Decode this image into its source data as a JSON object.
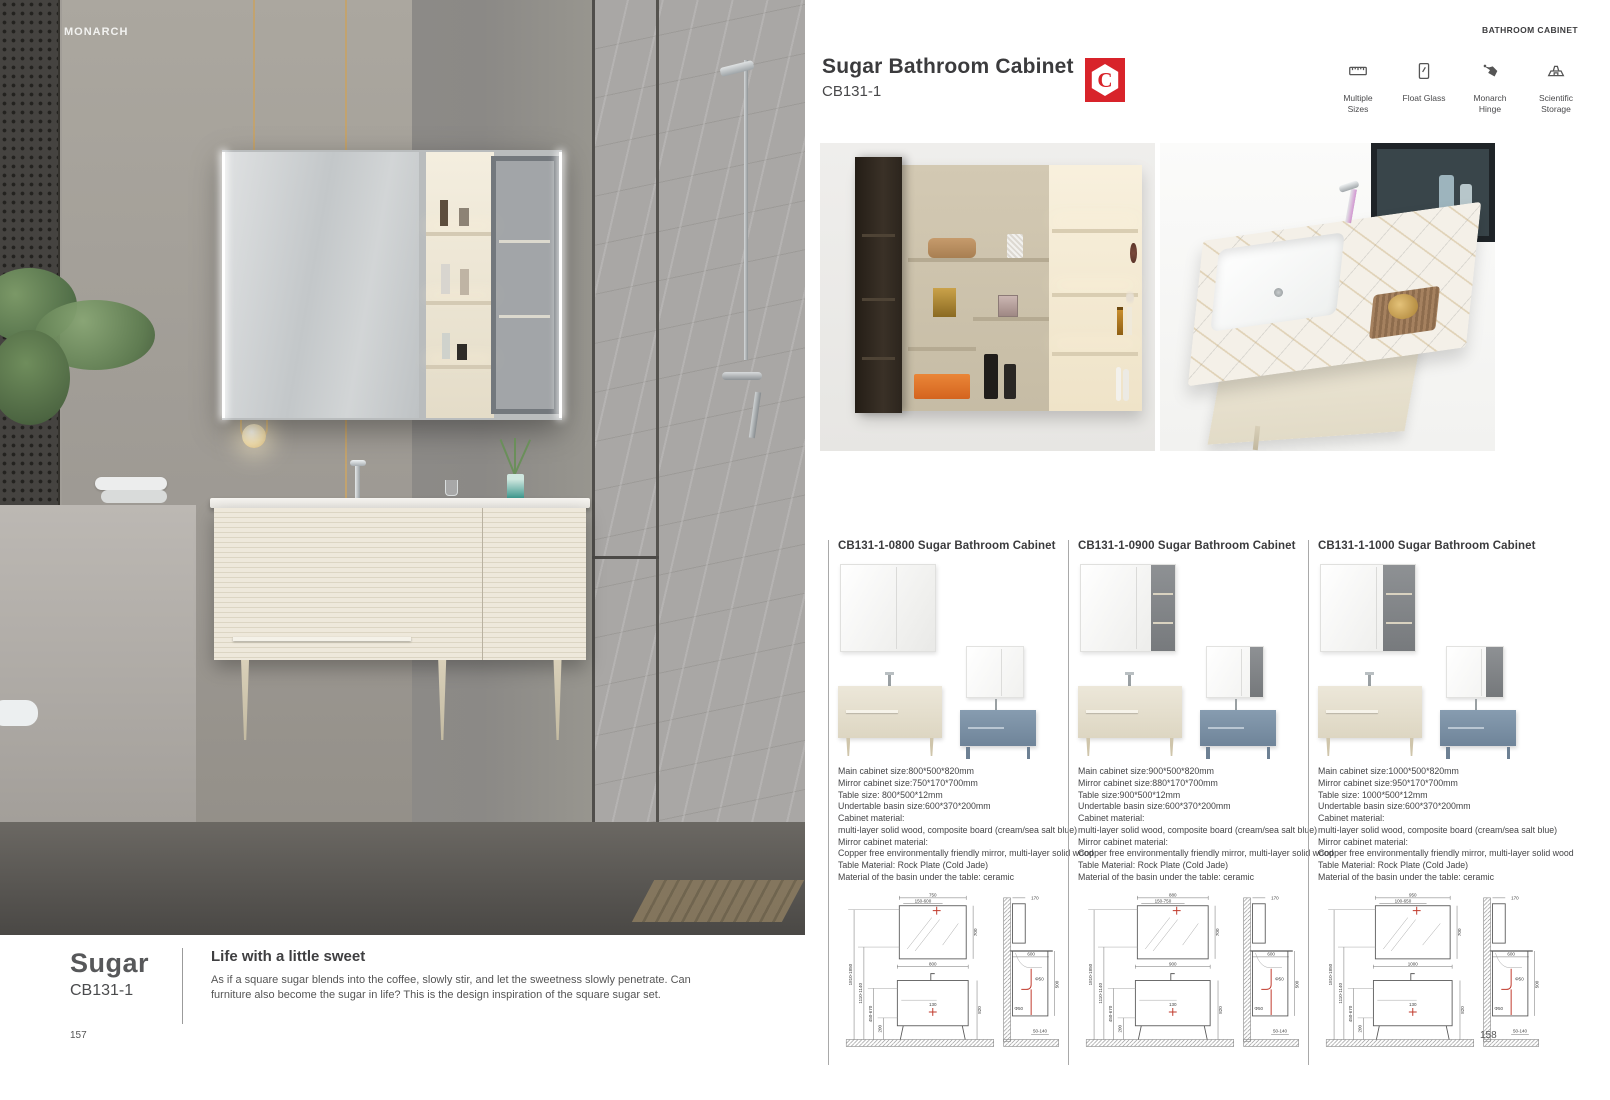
{
  "palette": {
    "accent_red": "#d8232a",
    "text_dark": "#3b3b3d",
    "cream": "#e8e3d6",
    "sea_salt_blue": "#7e93a6"
  },
  "left_page": {
    "brand": "MONARCH",
    "series_name": "Sugar",
    "series_code": "CB131-1",
    "slogan_title": "Life with a little sweet",
    "slogan_body": "As if a square sugar blends into the coffee, slowly stir, and let the sweetness slowly penetrate. Can furniture also become the sugar in life? This is the design inspiration of the square sugar set.",
    "page_number": "157"
  },
  "right_page": {
    "header_label": "BATHROOM CABINET",
    "title": "Sugar Bathroom Cabinet",
    "code": "CB131-1",
    "logo_letter": "C",
    "features": [
      {
        "icon": "multiple-sizes-icon",
        "label": "Multiple Sizes"
      },
      {
        "icon": "float-glass-icon",
        "label": "Float Glass"
      },
      {
        "icon": "monarch-hinge-icon",
        "label": "Monarch Hinge"
      },
      {
        "icon": "scientific-storage-icon",
        "label": "Scientific Storage"
      }
    ],
    "page_number": "158",
    "variants": [
      {
        "title": "CB131-1-0800 Sugar Bathroom Cabinet",
        "specs": [
          "Main cabinet size:800*500*820mm",
          "Mirror cabinet size:750*170*700mm",
          "Table size: 800*500*12mm",
          "Undertable basin size:600*370*200mm",
          "Cabinet material:",
          "multi-layer solid wood, composite board (cream/sea salt blue)",
          "Mirror cabinet material:",
          "Copper free environmentally friendly mirror, multi-layer solid wood",
          "Table Material: Rock Plate (Cold Jade)",
          "Material of the basin under the table: ceramic"
        ],
        "drawing": {
          "front": {
            "mirror_width": "750",
            "install_range": "150-600",
            "mirror_height": "700",
            "cabinet_width": "800",
            "cabinet_height": "820",
            "drain_offset": "130",
            "height_range_1": "1810-1850",
            "height_range_2": "1110-1140",
            "height_range_3": "450-670",
            "skirt_height": "200"
          },
          "side": {
            "depth": "170",
            "basin_width": "600",
            "height": "500",
            "drain_diameter": "Φ50",
            "floor_gap": "50-140"
          }
        }
      },
      {
        "title": "CB131-1-0900 Sugar Bathroom Cabinet",
        "specs": [
          "Main cabinet size:900*500*820mm",
          "Mirror cabinet size:880*170*700mm",
          "Table size:900*500*12mm",
          "Undertable basin size:600*370*200mm",
          "Cabinet material:",
          "multi-layer solid wood, composite board (cream/sea salt blue)",
          "Mirror cabinet material:",
          "Copper free environmentally friendly mirror, multi-layer solid wood",
          "Table Material: Rock Plate (Cold Jade)",
          "Material of the basin under the table: ceramic"
        ],
        "drawing": {
          "front": {
            "mirror_width": "880",
            "install_range": "150-750",
            "mirror_height": "700",
            "cabinet_width": "900",
            "cabinet_height": "820",
            "drain_offset": "130",
            "height_range_1": "1810-1850",
            "height_range_2": "1110-1140",
            "height_range_3": "450-670",
            "skirt_height": "200"
          },
          "side": {
            "depth": "170",
            "basin_width": "600",
            "height": "500",
            "drain_diameter": "Φ50",
            "floor_gap": "50-140"
          }
        }
      },
      {
        "title": "CB131-1-1000 Sugar Bathroom Cabinet",
        "specs": [
          "Main cabinet size:1000*500*820mm",
          "Mirror cabinet size:950*170*700mm",
          "Table size: 1000*500*12mm",
          "Undertable basin size:600*370*200mm",
          "Cabinet material:",
          "multi-layer solid wood, composite board (cream/sea salt blue)",
          "Mirror cabinet material:",
          "Copper free environmentally friendly mirror, multi-layer solid wood",
          "Table Material: Rock Plate (Cold Jade)",
          "Material of the basin under the table: ceramic"
        ],
        "drawing": {
          "front": {
            "mirror_width": "950",
            "install_range": "100-650",
            "mirror_height": "700",
            "cabinet_width": "1000",
            "cabinet_height": "820",
            "drain_offset": "130",
            "height_range_1": "1810-1850",
            "height_range_2": "1110-1140",
            "height_range_3": "450-670",
            "skirt_height": "200"
          },
          "side": {
            "depth": "170",
            "basin_width": "600",
            "height": "500",
            "drain_diameter": "Φ50",
            "floor_gap": "50-140"
          }
        }
      }
    ]
  }
}
